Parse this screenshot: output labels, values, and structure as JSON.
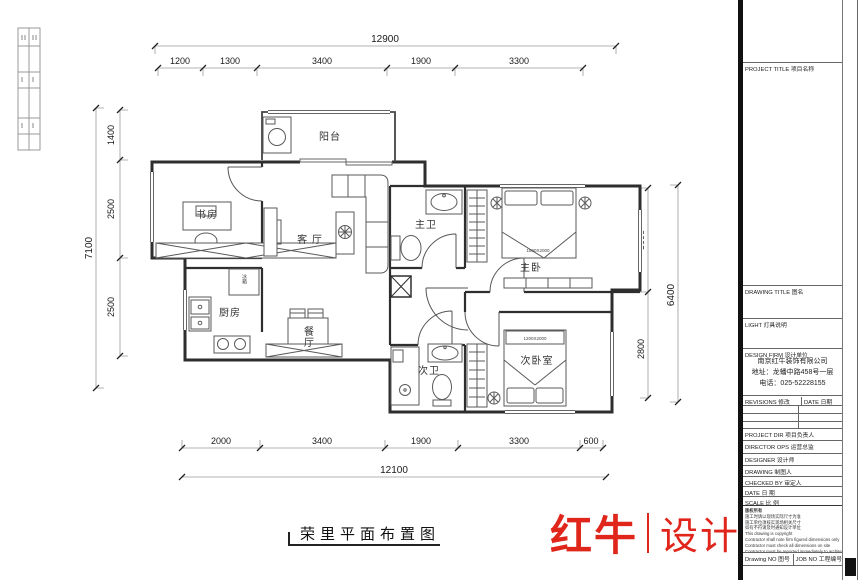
{
  "sheet": {
    "footer_title": "荣里平面布置图",
    "logo": {
      "primary": "红牛",
      "secondary": "设计",
      "color": "#e0251b"
    }
  },
  "plan": {
    "rooms": {
      "balcony": "阳台",
      "study": "书房",
      "living": "客 厅",
      "kitchen": "厨房",
      "dining": "餐厅",
      "fridge": "冰箱",
      "master_bath": "主卫",
      "master_bed": "主卧",
      "second_bath": "次卫",
      "second_bed": "次卧室"
    },
    "furniture": {
      "master_bed_size": "1800X2000",
      "second_bed_size": "1200X2000"
    }
  },
  "dims": {
    "top": {
      "total": "12900",
      "segments": [
        "1200",
        "1300",
        "3400",
        "1900",
        "3300"
      ]
    },
    "bottom": {
      "total": "12100",
      "segments": [
        "2000",
        "3400",
        "1900",
        "3300",
        "600"
      ]
    },
    "left": {
      "total": "7100",
      "segments": [
        "1400",
        "2500",
        "2500"
      ]
    },
    "right": {
      "total": "6400",
      "segments": [
        "3000",
        "2800"
      ]
    }
  },
  "titleblock": {
    "project_title": "PROJECT TITLE 项目名称",
    "drawing_title": "DRAWING TITLE 图名",
    "light_row": "LIGHT 灯具说明",
    "design_firm": "DESIGN FIRM 设计单位",
    "firm_name": "南京红牛装饰有限公司",
    "firm_addr": "地址：龙蟠中路458号一层",
    "firm_tel": "电话：025-52228155",
    "revisions": "REVISIONS 修改",
    "date_header": "DATE 日期",
    "rows": [
      {
        "label": "PROJECT DIR 项目负责人"
      },
      {
        "label": "DIRECTOR OPS 运营总监"
      },
      {
        "label": "DESIGNER 设计师"
      },
      {
        "label": "DRAWING 制图人"
      },
      {
        "label": "CHECKED BY 审定人"
      },
      {
        "label": "DATE 日 期"
      },
      {
        "label": "SCALE 比 例"
      }
    ],
    "notes": [
      "版权所有",
      "施工时请以现场实际尺寸为准",
      "施工单位须核实现场相关尺寸",
      "如有不符请及时通知设计单位",
      "This drawing is copyright",
      "Contractor shall note firm figured dimensions only",
      "Contractor must check all dimensions on site",
      "Contractor must be reported immediately to architects"
    ],
    "drawing_no": "Drawing NO 图号",
    "job_no": "JOB NO 工程编号"
  }
}
